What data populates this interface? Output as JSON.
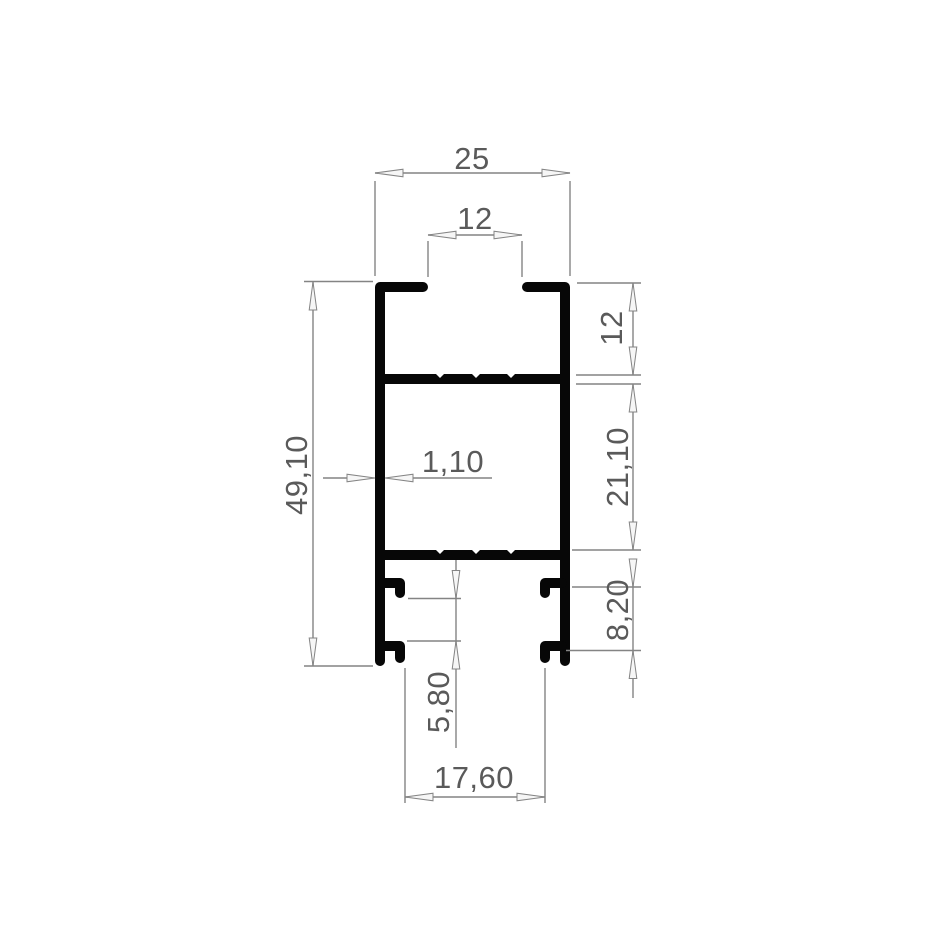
{
  "drawing": {
    "kind": "aluminium-profile-cross-section",
    "labels": {
      "overall_width": "25",
      "slot_width": "12",
      "overall_height": "49,10",
      "upper_chamber_height": "12",
      "middle_chamber_height": "21,10",
      "lower_section_height": "8,20",
      "hook_spacing": "5,80",
      "wall_thickness": "1,10",
      "base_opening_width": "17,60"
    },
    "colors": {
      "background": "#ffffff",
      "profile": "#070707",
      "dimension_line": "#848484",
      "arrow_fill": "#f6f6f6",
      "dimension_text": "#5a5a5a"
    }
  }
}
